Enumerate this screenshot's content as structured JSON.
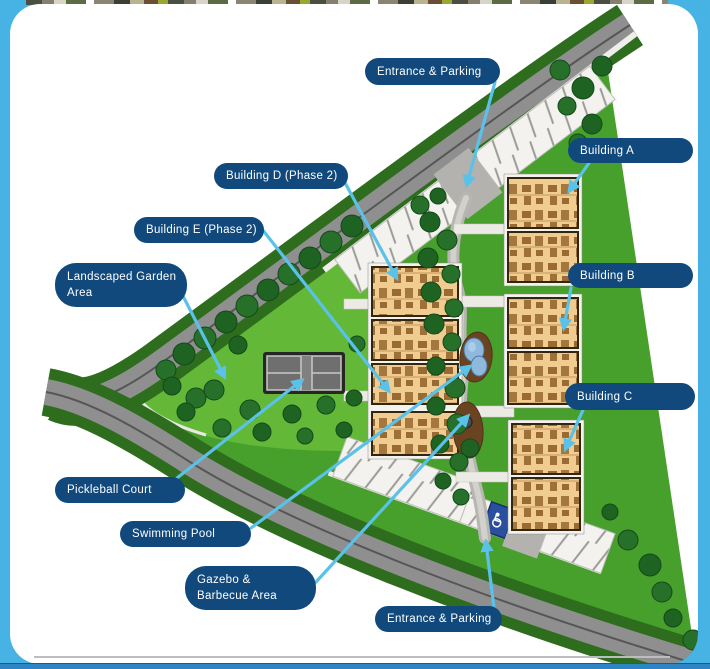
{
  "slide": {
    "figure_type": "residential site plan with callout labels",
    "callouts": {
      "entrance_top": "Entrance & Parking",
      "building_a": "Building A",
      "building_d": "Building D (Phase 2)",
      "building_e": "Building E (Phase 2)",
      "garden_line1": "Landscaped Garden",
      "garden_line2": "Area",
      "building_b": "Building B",
      "building_c": "Building C",
      "pickleball": "Pickleball Court",
      "pool": "Swimming Pool",
      "gazebo_line1": "Gazebo &",
      "gazebo_line2": "Barbecue Area",
      "entrance_bottom": "Entrance & Parking"
    },
    "colors": {
      "pill_navy": "#11497d",
      "arrow_blue": "#5ac1e9",
      "frame_cyan": "#47b2e4",
      "bottom_bar_blue": "#2e85c6",
      "lawn_green": "#46a02b",
      "garden_green": "#63b838",
      "verge_green": "#2e6d1e",
      "road_gray": "#8f8f8f",
      "building_tan": "#f0cc90",
      "pool_blue": "#8fb9dc",
      "divider_gray": "#bdbdbd"
    }
  }
}
